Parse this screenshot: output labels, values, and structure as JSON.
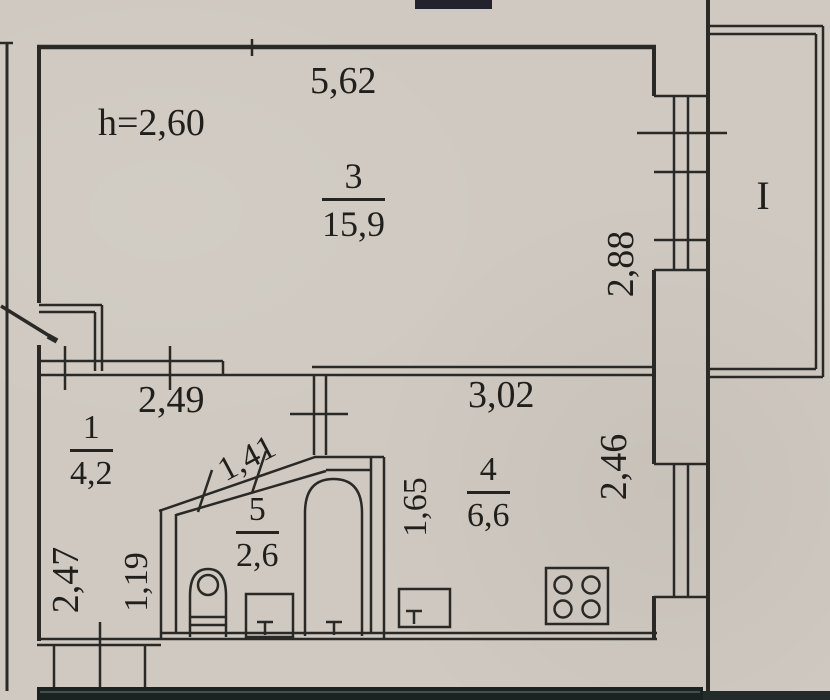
{
  "labels": {
    "ceiling_height": "h=2,60",
    "room3_width": "5,62",
    "room3_depth": "2,88",
    "hall_width": "2,49",
    "hall_depth": "2,47",
    "hall_side": "1,19",
    "bath_diagonal": "1,41",
    "kitchen_width": "3,02",
    "kitchen_depth": "2,46",
    "kitchen_side": "1,65",
    "balcony_mark": "I"
  },
  "rooms": [
    {
      "number": "3",
      "area": "15,9"
    },
    {
      "number": "1",
      "area": "4,2"
    },
    {
      "number": "5",
      "area": "2,6"
    },
    {
      "number": "4",
      "area": "6,6"
    }
  ],
  "colors": {
    "paper": "#cfc9c1",
    "ink": "#2b2926",
    "scan_band": "#1a2321"
  }
}
